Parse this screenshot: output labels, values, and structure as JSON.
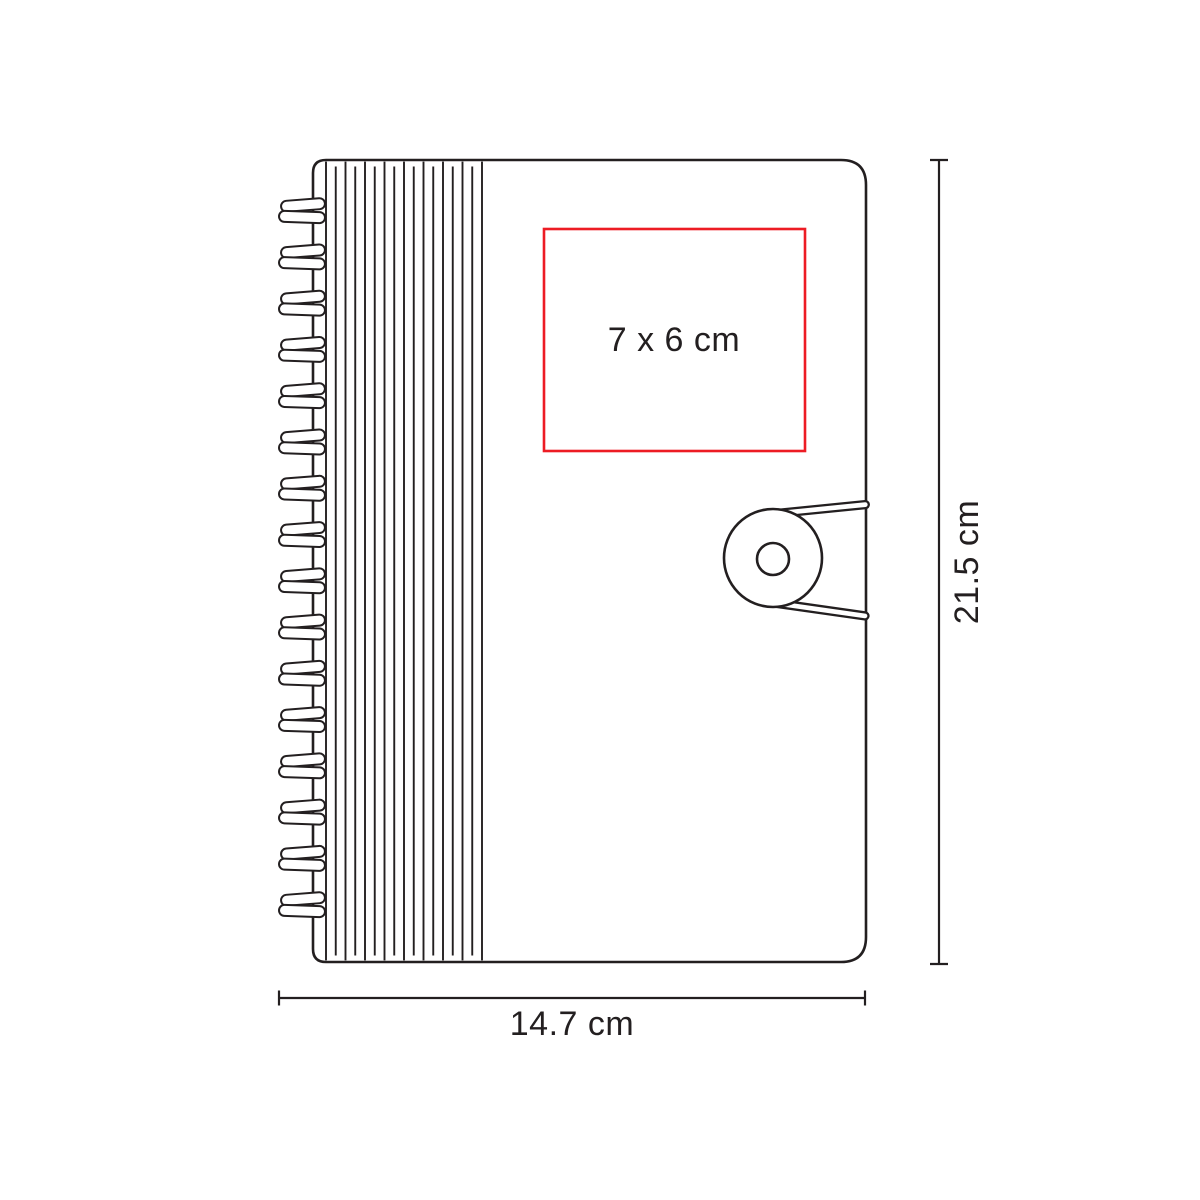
{
  "page": {
    "background": "#ffffff",
    "content_type": "product dimension diagram"
  },
  "drawing": {
    "spiral_coil_count": 16,
    "rib_line_count": 17
  },
  "imprint_area": {
    "label": "7 x 6 cm"
  },
  "dimensions": {
    "height": {
      "label": "21.5 cm"
    },
    "width": {
      "label": "14.7 cm"
    }
  },
  "colors": {
    "ink": "#231f20",
    "imprint_red": "#ed1c24",
    "background": "#ffffff"
  }
}
